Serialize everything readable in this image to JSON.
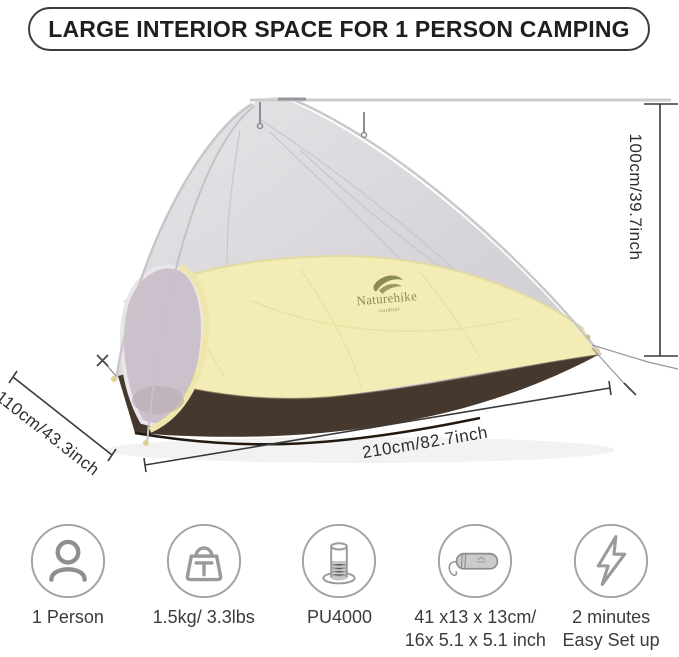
{
  "banner": {
    "title": "LARGE INTERIOR SPACE FOR 1 PERSON CAMPING"
  },
  "tent": {
    "brand": "Naturehike",
    "brand_sub": "outdoor",
    "colors": {
      "mesh_gray": "#d7d5d9",
      "canopy_yellow": "#f3edb5",
      "floor_brown": "#46382c",
      "pole_gray": "#c7c6c9",
      "logo_olive": "#8b8c51"
    }
  },
  "dimensions": {
    "height": "100cm/39.7inch",
    "width": "110cm/43.3inch",
    "length": "210cm/82.7inch"
  },
  "features": [
    {
      "icon": "person-icon",
      "lines": [
        "1 Person"
      ]
    },
    {
      "icon": "weight-icon",
      "lines": [
        "1.5kg/ 3.3lbs"
      ]
    },
    {
      "icon": "waterproof-icon",
      "lines": [
        "PU4000"
      ]
    },
    {
      "icon": "packed-size-icon",
      "lines": [
        "41 x13 x 13cm/",
        "16x 5.1 x 5.1 inch"
      ]
    },
    {
      "icon": "quick-setup-icon",
      "lines": [
        "2 minutes",
        "Easy Set up"
      ]
    }
  ]
}
